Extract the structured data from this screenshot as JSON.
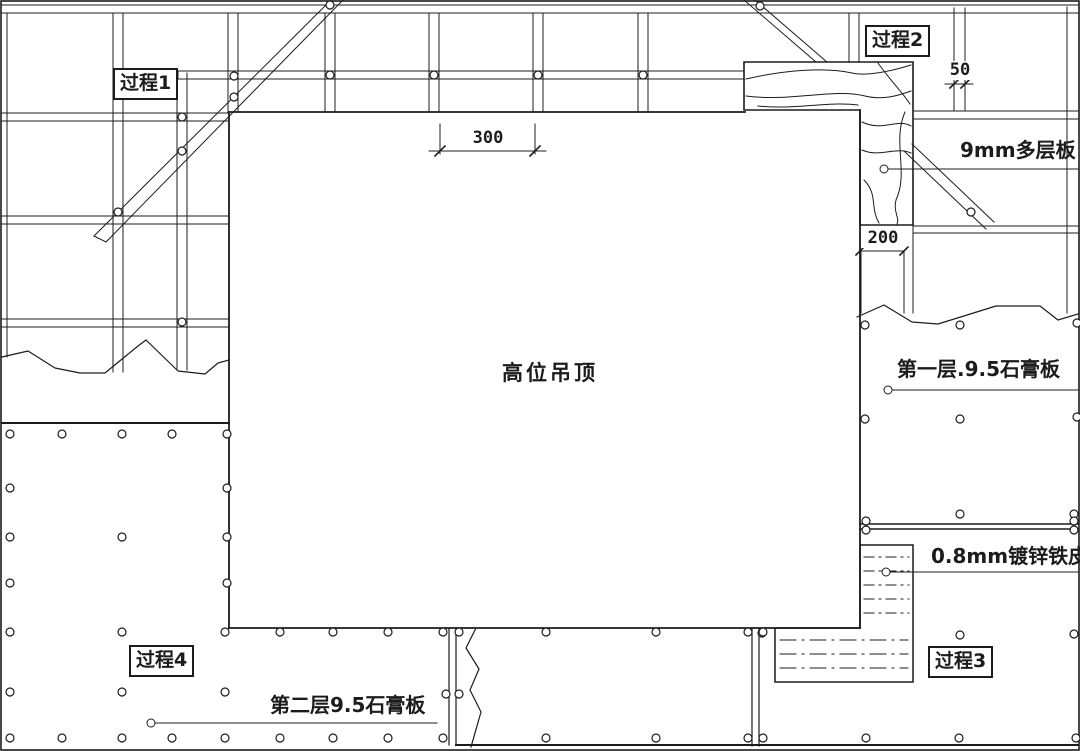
{
  "colors": {
    "ink": "#1c1c1c",
    "paper": "#ffffff"
  },
  "annotations": {
    "process1": "过程1",
    "process2": "过程2",
    "process3": "过程3",
    "process4": "过程4",
    "center_label": "高位吊顶",
    "plywood": "9mm多层板",
    "gypsum_layer1": "第一层.9.5石膏板",
    "zinc_sheet": "0.8mm镀锌铁皮",
    "gypsum_layer2": "第二层9.5石膏板"
  },
  "dimensions": {
    "top_dim": "300",
    "rail_width_dim": "50",
    "column_dim": "200"
  }
}
